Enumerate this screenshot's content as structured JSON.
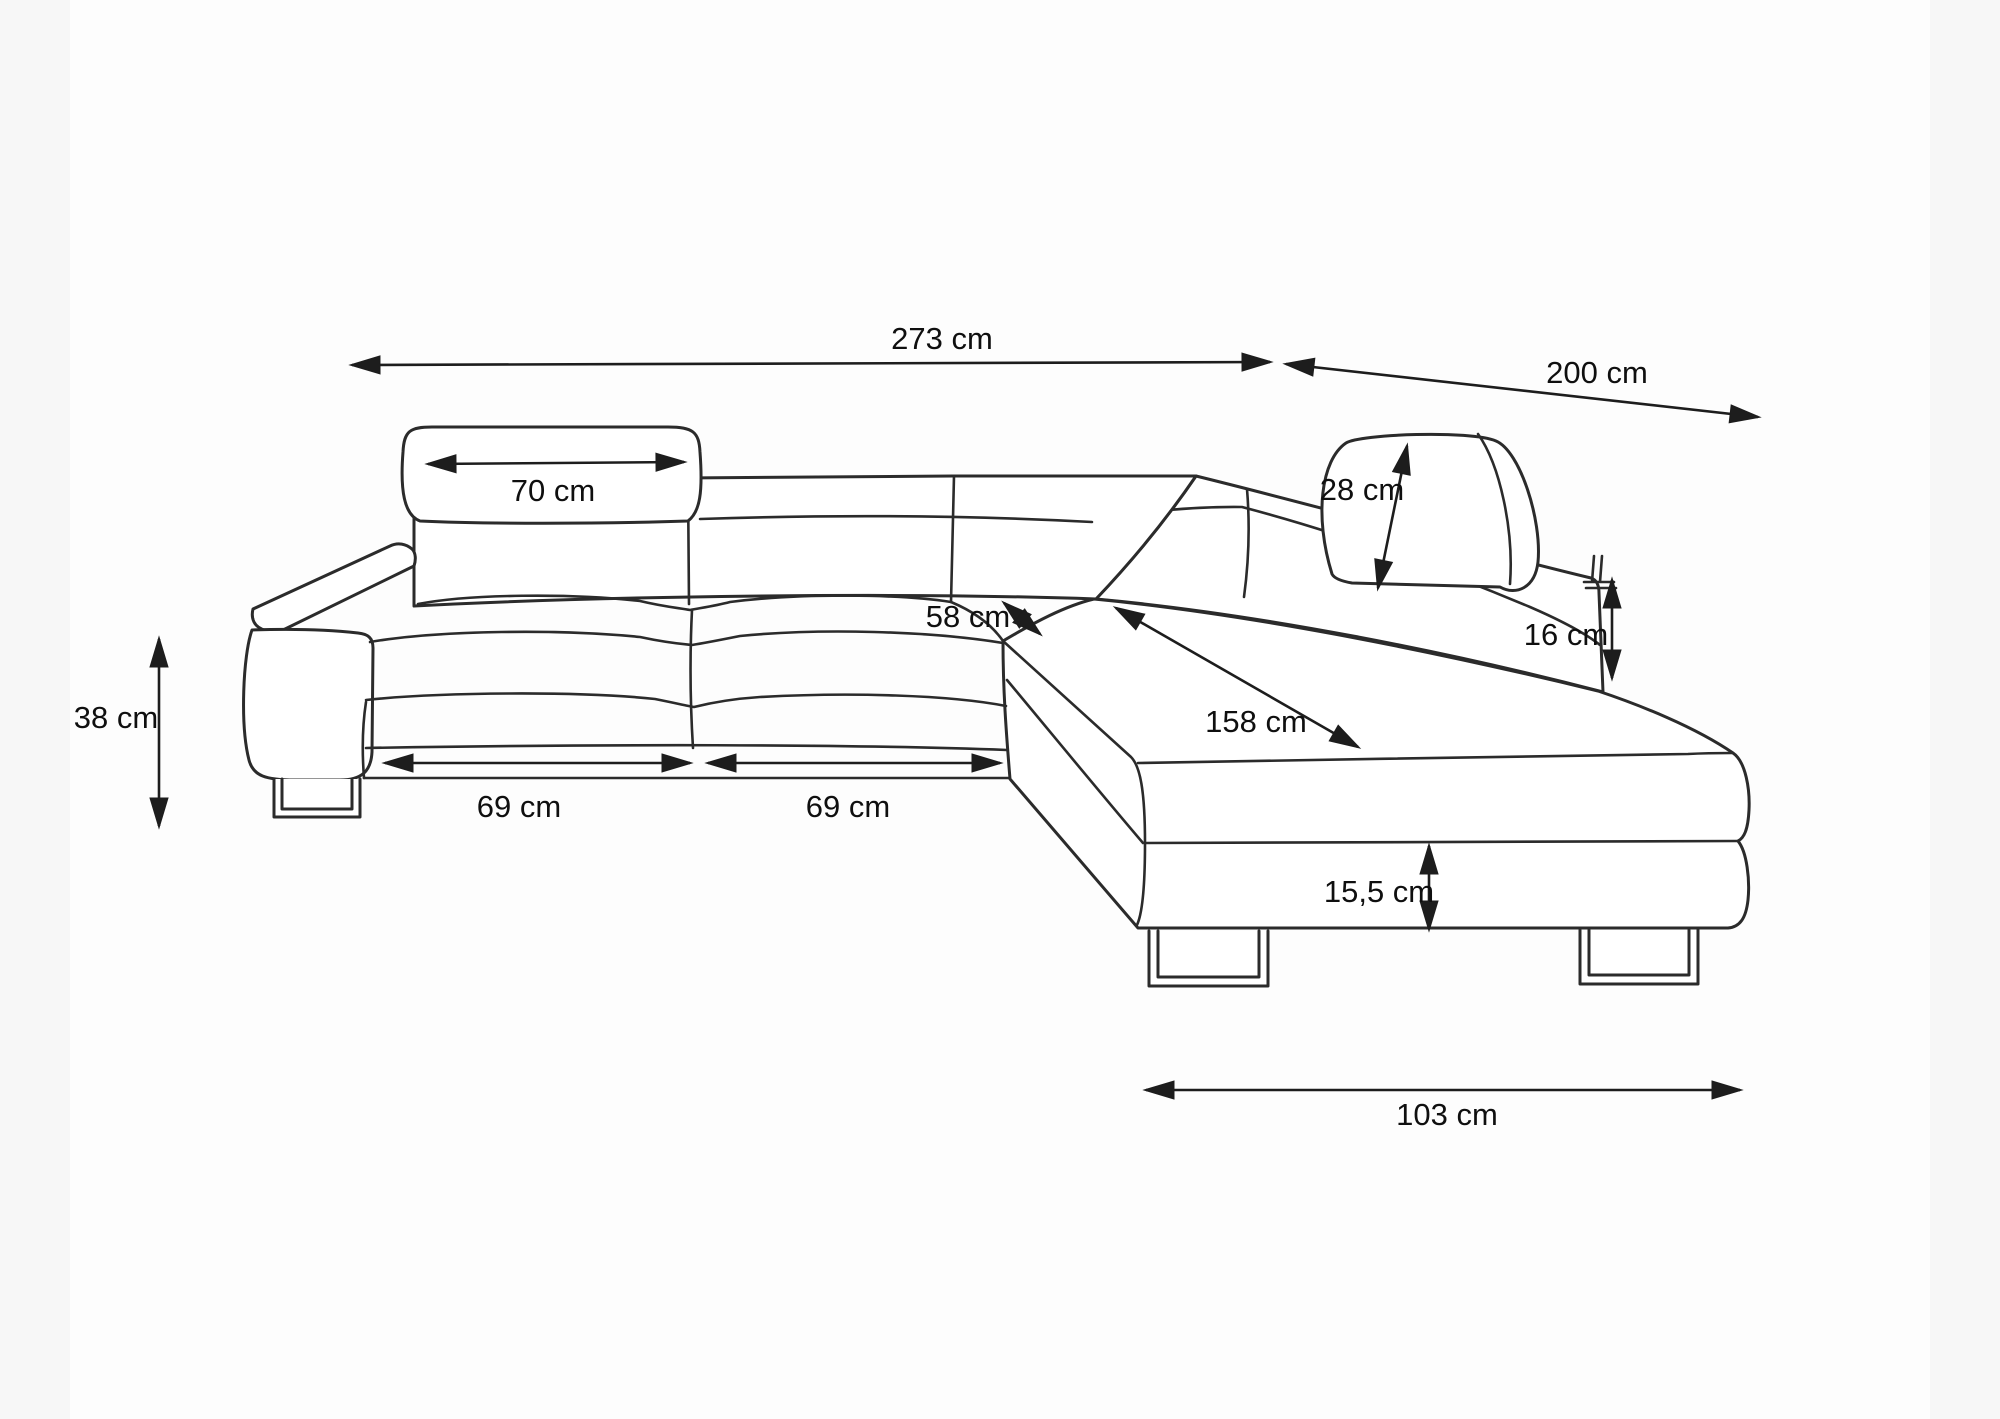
{
  "colors": {
    "background": "#fdfdfd",
    "line": "#2b2b2b",
    "text": "#0f0f0f"
  },
  "dimensions": {
    "total_width": {
      "label": "273 cm"
    },
    "total_depth": {
      "label": "200 cm"
    },
    "headrest_width": {
      "label": "70 cm"
    },
    "headrest_height": {
      "label": "28 cm"
    },
    "backrest_above_seat": {
      "label": "16 cm"
    },
    "armrest_height": {
      "label": "38 cm"
    },
    "corner_seat_depth": {
      "label": "58 cm"
    },
    "sleeping_length": {
      "label": "158 cm"
    },
    "seat_width_left": {
      "label": "69 cm"
    },
    "seat_width_right": {
      "label": "69 cm"
    },
    "base_height": {
      "label": "15,5 cm"
    },
    "chaise_width": {
      "label": "103 cm"
    }
  }
}
